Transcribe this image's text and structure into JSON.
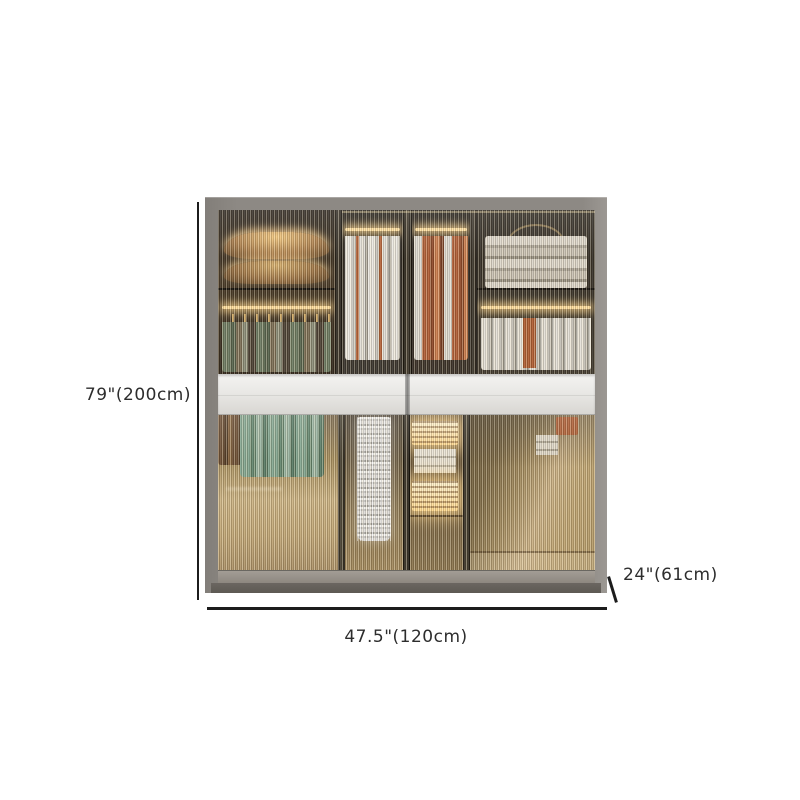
{
  "product_diagram": {
    "type": "furniture-dimension-image",
    "item": "sliding-door fluted-glass wardrobe with lit interior",
    "dimensions": {
      "height": "79\"(200cm)",
      "width": "47.5\"(120cm)",
      "depth": "24\"(61cm)"
    }
  },
  "colors": {
    "line": "#1c1c1c",
    "label_text": "#2d2d2d",
    "frame": "#8d8984",
    "frame_base": "#6b6661",
    "glass_amber": "#c0a878",
    "drawer_band": "#eceae7",
    "led_glow": "#ffdf9e",
    "clothes_green": "#7fa28c",
    "clothes_orange": "#b06038",
    "clothes_white": "#e9e6df",
    "interior_dark": "#38322a"
  }
}
